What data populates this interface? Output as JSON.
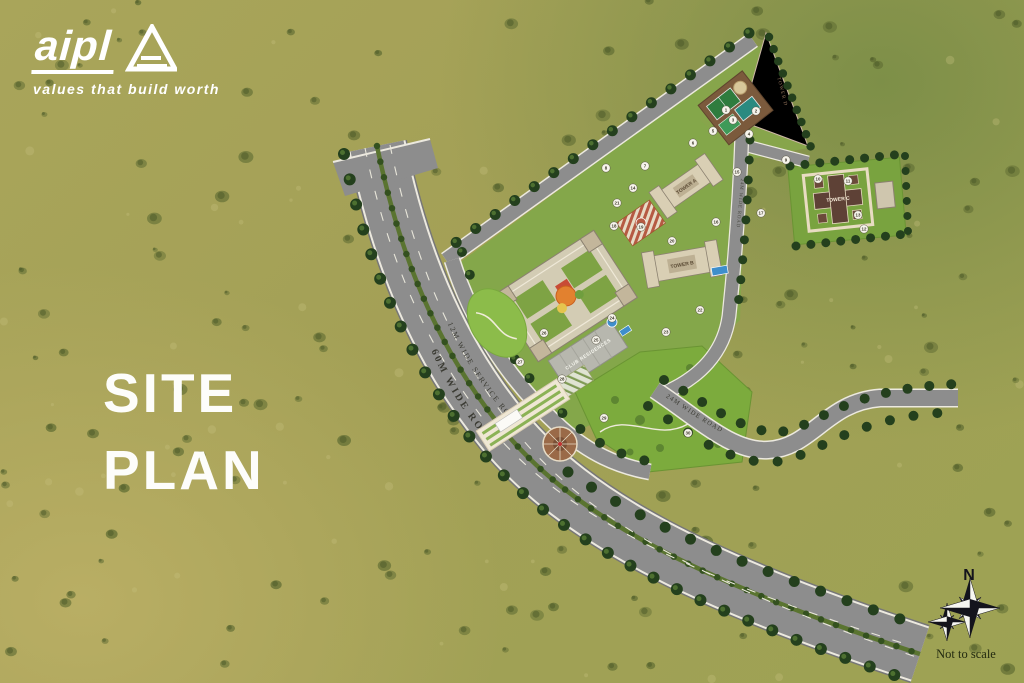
{
  "branding": {
    "logo_text": "aipl",
    "tagline": "values that build worth"
  },
  "title": {
    "line1": "SITE",
    "line2": "PLAN"
  },
  "compass": {
    "north": "N",
    "note": "Not to scale"
  },
  "plan": {
    "roads": {
      "main": "60M WIDE ROAD",
      "service": "12M WIDE SERVICE ROAD",
      "internal": "24M WIDE ROAD"
    },
    "buildings": {
      "tower_a": "TOWER A",
      "tower_b": "TOWER B",
      "tower_c": "TOWER C",
      "club": "CLUB RESIDENCES",
      "parcel": "TOWER D"
    },
    "markers": [
      {
        "n": 1,
        "x": 726,
        "y": 110
      },
      {
        "n": 2,
        "x": 756,
        "y": 111
      },
      {
        "n": 3,
        "x": 733,
        "y": 120
      },
      {
        "n": 4,
        "x": 749,
        "y": 134
      },
      {
        "n": 5,
        "x": 713,
        "y": 131
      },
      {
        "n": 6,
        "x": 693,
        "y": 143
      },
      {
        "n": 7,
        "x": 645,
        "y": 166
      },
      {
        "n": 8,
        "x": 606,
        "y": 168
      },
      {
        "n": 9,
        "x": 786,
        "y": 160
      },
      {
        "n": 10,
        "x": 818,
        "y": 179
      },
      {
        "n": 11,
        "x": 848,
        "y": 181
      },
      {
        "n": 12,
        "x": 864,
        "y": 229
      },
      {
        "n": 13,
        "x": 858,
        "y": 215
      },
      {
        "n": 14,
        "x": 633,
        "y": 188
      },
      {
        "n": 15,
        "x": 737,
        "y": 172
      },
      {
        "n": 16,
        "x": 716,
        "y": 222
      },
      {
        "n": 17,
        "x": 761,
        "y": 213
      },
      {
        "n": 18,
        "x": 614,
        "y": 226
      },
      {
        "n": 19,
        "x": 641,
        "y": 227
      },
      {
        "n": 20,
        "x": 672,
        "y": 241
      },
      {
        "n": 21,
        "x": 617,
        "y": 203
      },
      {
        "n": 22,
        "x": 700,
        "y": 310
      },
      {
        "n": 23,
        "x": 666,
        "y": 332
      },
      {
        "n": 24,
        "x": 612,
        "y": 318
      },
      {
        "n": 25,
        "x": 596,
        "y": 340
      },
      {
        "n": 26,
        "x": 544,
        "y": 333
      },
      {
        "n": 27,
        "x": 520,
        "y": 362
      },
      {
        "n": 28,
        "x": 562,
        "y": 379
      },
      {
        "n": 29,
        "x": 604,
        "y": 418
      },
      {
        "n": 30,
        "x": 688,
        "y": 433
      }
    ]
  },
  "colors": {
    "canvas_olive": "#a9a55a",
    "canvas_green": "#7d8f48",
    "canvas_yellow": "#b9ae64",
    "road_gray": "#8d8d8d",
    "lawn_green": "#84a74a",
    "bright_lawn": "#7cab3d",
    "tree_green": "#24401d",
    "pool_blue": "#3e8ecb",
    "cream_parcel": "#ead9c9",
    "title_white": "#ffffff",
    "compass_ink": "#14141c"
  }
}
